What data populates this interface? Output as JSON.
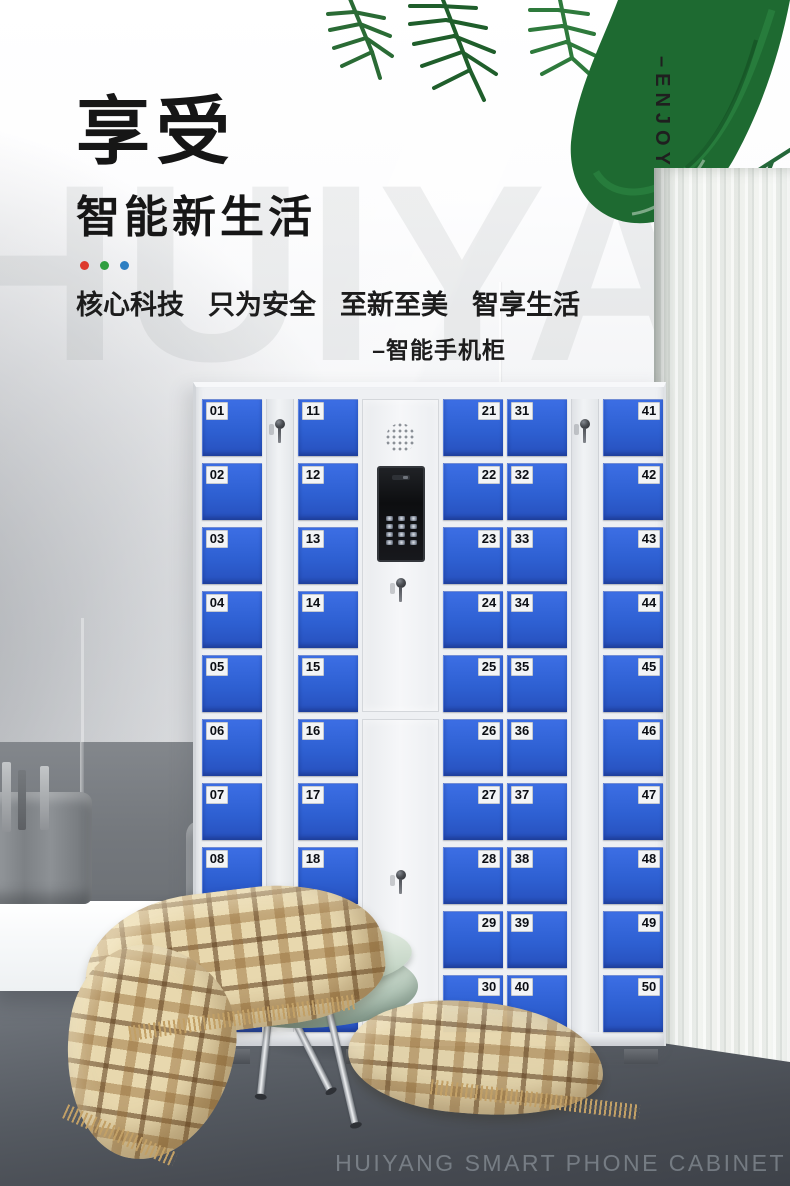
{
  "hero": {
    "title": "享受",
    "subtitle": "智能新生活",
    "dot_colors": [
      "#dd3a2c",
      "#2f9e3f",
      "#2e7fc2"
    ],
    "tagline_items": [
      "核心科技",
      "只为安全",
      "至新至美",
      "智享生活"
    ],
    "tagline_note": "–智能手机柜",
    "side_label": "–ENJOY",
    "watermark": "HUIYANG"
  },
  "cabinet": {
    "door_color": "#2e60d2",
    "door_color_light": "#3c6ee4",
    "door_color_dark": "#2750bd",
    "columns": [
      {
        "id": "locker-column-01-10",
        "type": "doors",
        "label_side": "left",
        "doors": [
          "01",
          "02",
          "03",
          "04",
          "05",
          "06",
          "07",
          "08",
          "09",
          "10"
        ]
      },
      {
        "id": "key-strip-left",
        "type": "keystrip"
      },
      {
        "id": "locker-column-11-20",
        "type": "doors",
        "label_side": "left",
        "doors": [
          "11",
          "12",
          "13",
          "14",
          "15",
          "16",
          "17",
          "18",
          "19",
          "20"
        ]
      },
      {
        "id": "control-column",
        "type": "control"
      },
      {
        "id": "locker-column-21-30",
        "type": "doors",
        "label_side": "right",
        "doors": [
          "21",
          "22",
          "23",
          "24",
          "25",
          "26",
          "27",
          "28",
          "29",
          "30"
        ]
      },
      {
        "id": "locker-column-31-40",
        "type": "doors",
        "label_side": "left",
        "doors": [
          "31",
          "32",
          "33",
          "34",
          "35",
          "36",
          "37",
          "38",
          "39",
          "40"
        ]
      },
      {
        "id": "key-strip-right",
        "type": "keystrip"
      },
      {
        "id": "locker-column-41-50",
        "type": "doors",
        "label_side": "right",
        "doors": [
          "41",
          "42",
          "43",
          "44",
          "45",
          "46",
          "47",
          "48",
          "49",
          "50"
        ]
      }
    ],
    "keypad_keys": 12
  },
  "footer": {
    "caption": "HUIYANG SMART PHONE CABINET"
  }
}
